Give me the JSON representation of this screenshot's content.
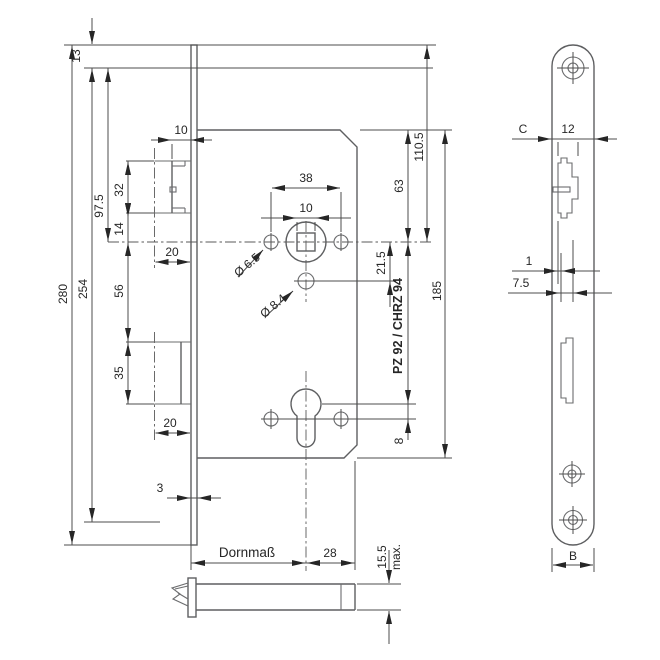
{
  "drawing_type": "mortise-lock technical drawing, two views",
  "main_view": {
    "vertical_dims": {
      "top_hole_offset": "13",
      "plate_total": "280",
      "hole_spacing": "254",
      "hole_to_axis": "97.5",
      "latch_height": "32",
      "latch_bottom_to_axis": "14",
      "axis_to_bolt": "56",
      "bolt_height": "35",
      "hole_below_axis": "21.5",
      "case_top_to_axis": "63",
      "plate_top_to_axis": "110.5",
      "case_height": "185",
      "cylinder_spec": "PZ 92 / CHRZ 94",
      "cyl_axis_to_screw": "8"
    },
    "horizontal_dims": {
      "latch_protrusion": "10",
      "follower_holes_span": "38",
      "square_follower": "10",
      "latch_throw": "20",
      "bolt_throw": "20",
      "plate_thickness": "3",
      "backset_label": "Dornmaß",
      "axis_to_case_back": "28"
    },
    "hole_dims": {
      "follower_side_hole": "Ø 6.5",
      "below_axis_hole": "Ø 8.4"
    },
    "latch_bar": {
      "height": "15.5",
      "note": "max."
    }
  },
  "faceplate_view": {
    "dims": {
      "edge_ref": "C",
      "latch_cutout_width": "12",
      "step": "1",
      "offset": "7.5",
      "plate_width_ref": "B"
    }
  }
}
